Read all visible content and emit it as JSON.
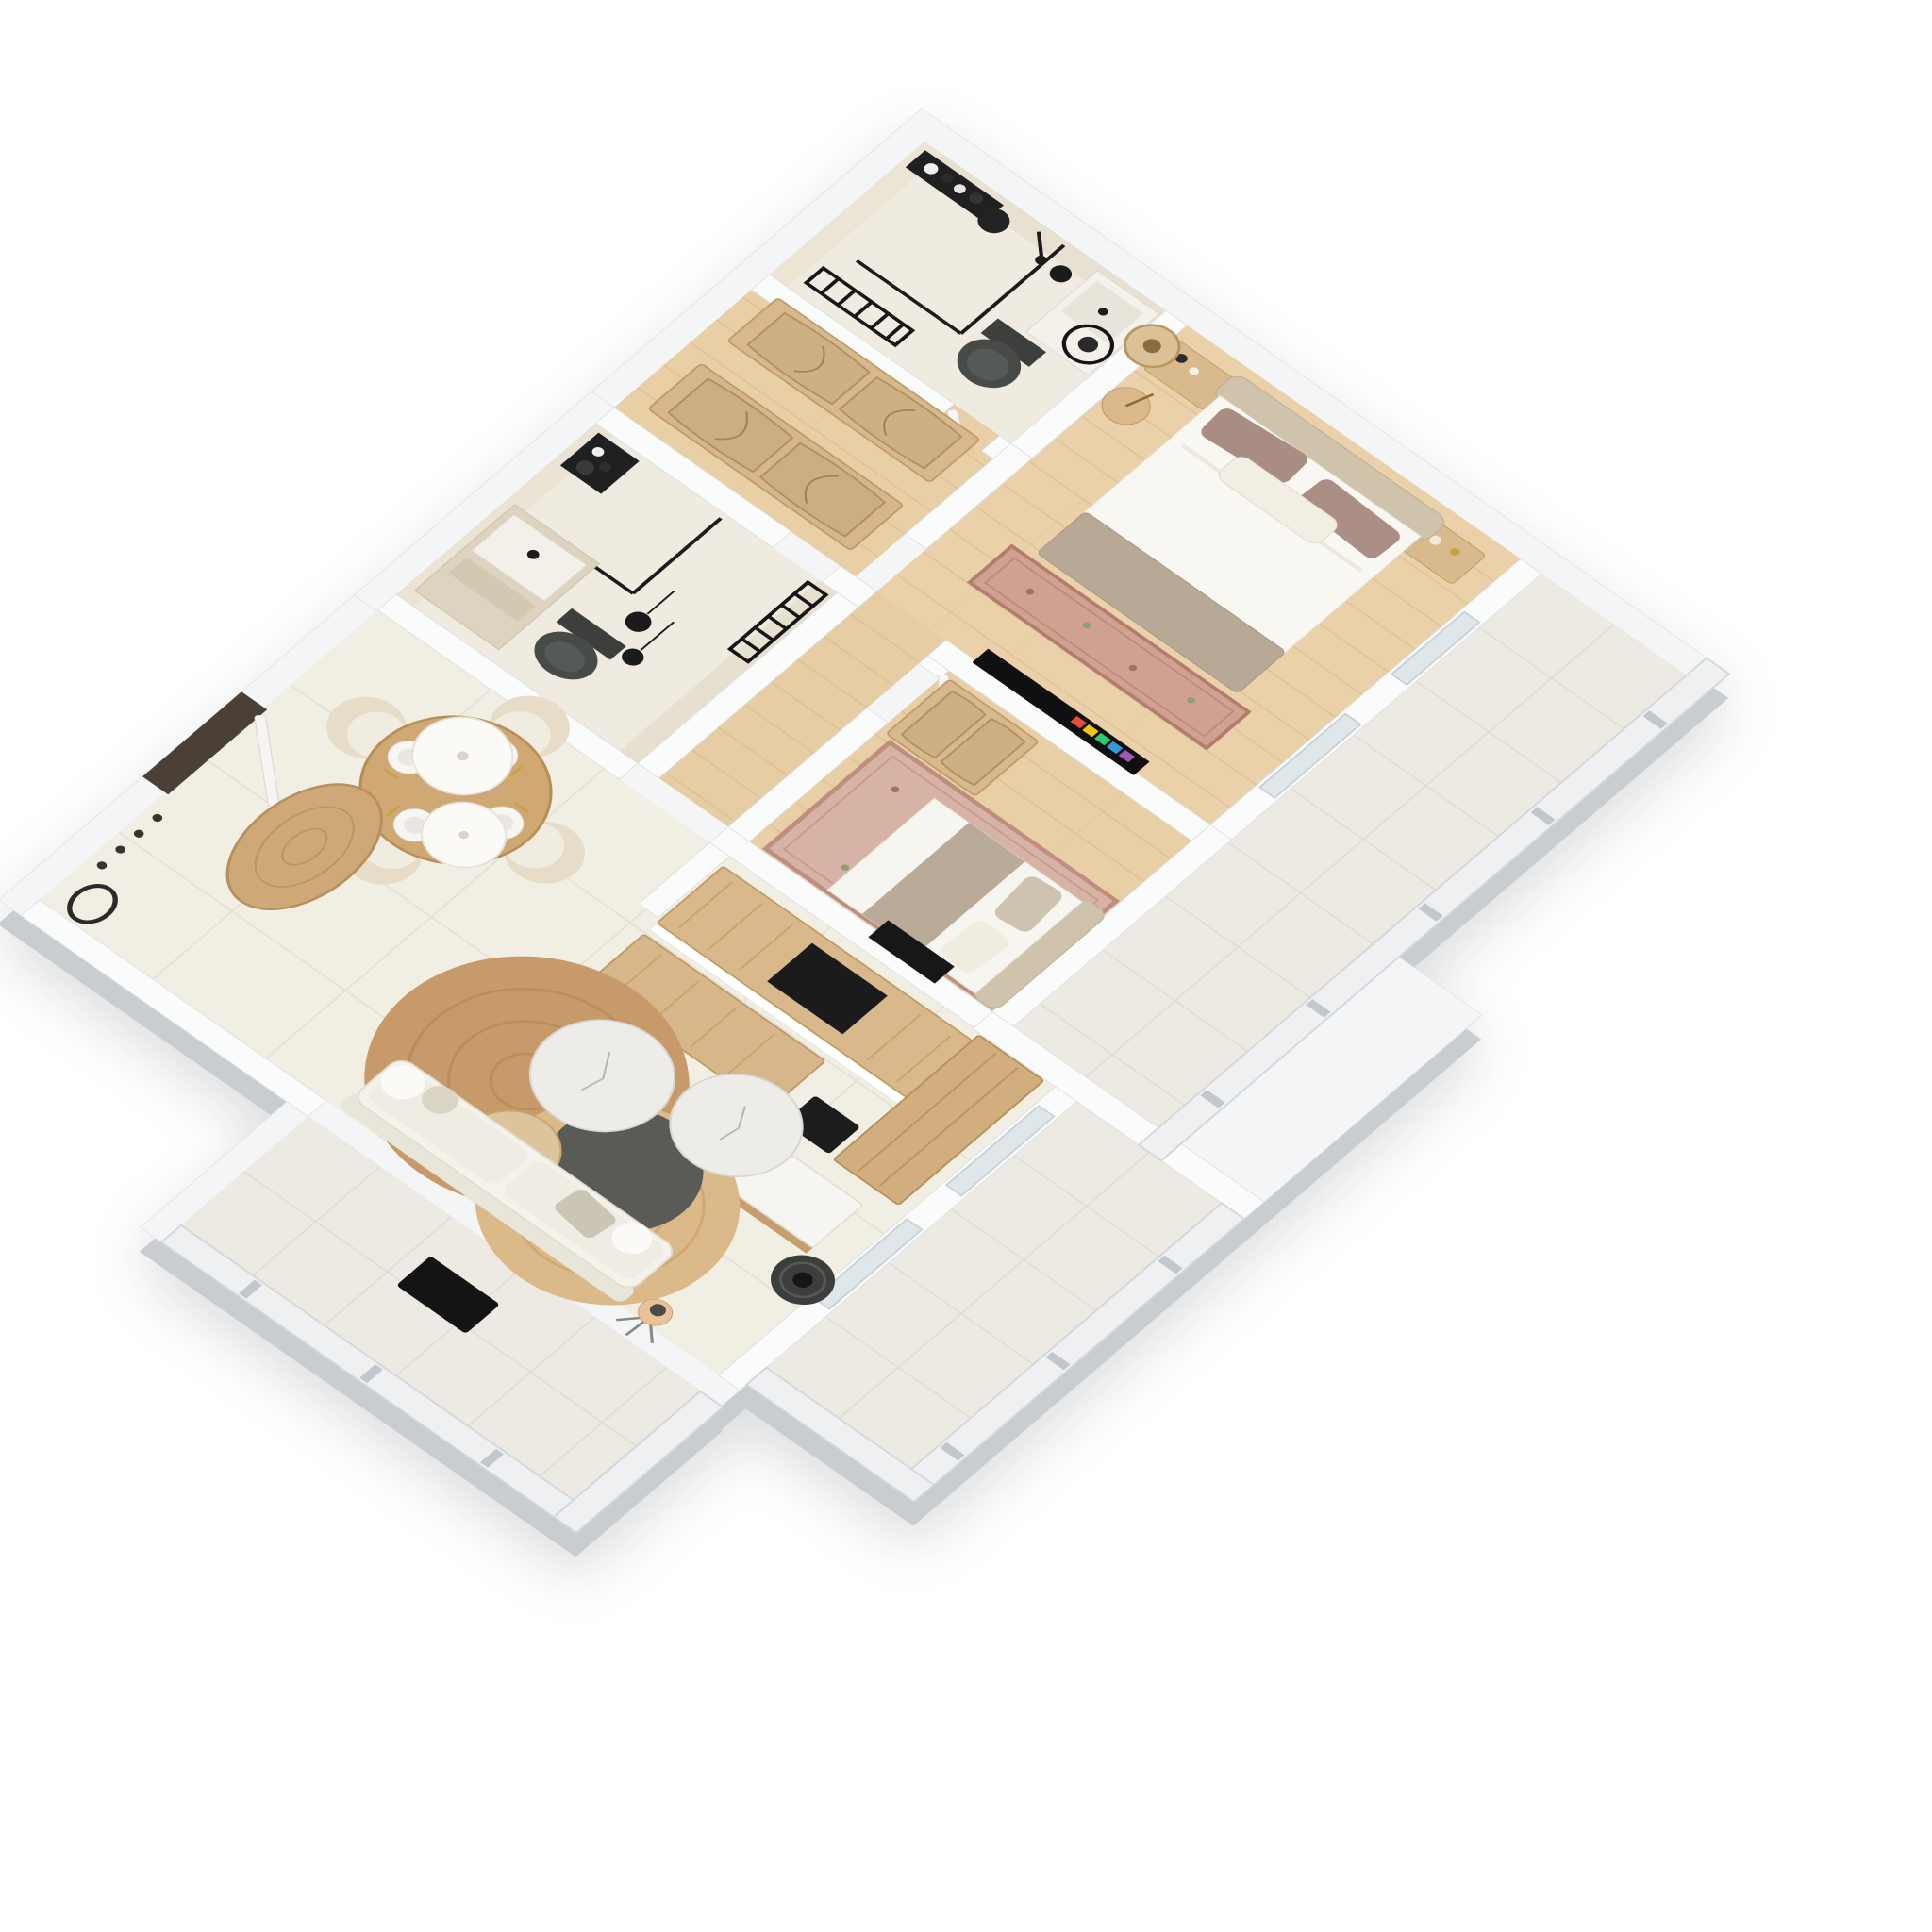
{
  "scene": {
    "kind": "3d-isometric-floorplan-render",
    "style": "scandinavian apartment, top-down dimetric camera",
    "background": "#ffffff"
  },
  "palette": {
    "wall_top": "#f4f5f6",
    "wall_side": "#c9ccd0",
    "wall_inner_beige": "#e4ddcd",
    "tile_floor": "#f1eee4",
    "bath_floor": "#efebe0",
    "wood_floor": "#e9cfa6",
    "wood_furniture": "#d9b98c",
    "rattan": "#d3b488",
    "jute_dark": "#c89a6a",
    "jute_light": "#dcb988",
    "marble": "#edece8",
    "dark_table": "#5a5a57",
    "sofa": "#f4f2ea",
    "duvet": "#f8f7f2",
    "blanket_taupe": "#b7a995",
    "pillow_mauve": "#a98c83",
    "headboard": "#cfc3ab",
    "rug_oriental": "#d0a091",
    "fixture_black": "#1c1c1c",
    "toilet_gray": "#474a47",
    "door_frame_dark": "#4a4038",
    "glass_railing": "#eef0f2",
    "tv_icon_colors": [
      "#e74c3c",
      "#f1c40f",
      "#2ecc71",
      "#3498db",
      "#9b59b6",
      "#e67e22"
    ],
    "book_colors": [
      "#c0392b",
      "#2980b9",
      "#16a085",
      "#f39c12",
      "#8e44ad",
      "#2c3e50"
    ]
  },
  "rooms": [
    {
      "id": "bathroom-ensuite",
      "label": "Ensuite bathroom",
      "furniture": [
        "walk-in shower with black glass",
        "toiletry shelf",
        "black towel radiator",
        "dark wall-hung toilet",
        "vanity sink with black faucet",
        "round black mirror",
        "black pendant lamp"
      ]
    },
    {
      "id": "hallway-wardrobes",
      "label": "Hallway with wardrobes",
      "furniture": [
        "rattan cane wardrobe",
        "rattan cane wardrobe"
      ]
    },
    {
      "id": "master-bedroom",
      "label": "Master bedroom",
      "furniture": [
        "double bed with white duvet, taupe throw and mauve pillows",
        "upholstered headboard",
        "wood bench",
        "nightstand",
        "two rattan pendant lamps",
        "plant stool",
        "oriental runner rug",
        "wall TV with app icons"
      ]
    },
    {
      "id": "balcony-east",
      "label": "East balcony",
      "furniture": [
        "glass railing",
        "tile floor"
      ]
    },
    {
      "id": "second-bedroom",
      "label": "Second bedroom",
      "furniture": [
        "double bed with beige throw",
        "rattan cane wardrobe",
        "large oriental rug",
        "dark wall niche"
      ]
    },
    {
      "id": "bathroom-second",
      "label": "Second bathroom",
      "furniture": [
        "corner shower with black glass",
        "toiletry shelf",
        "black towel radiator",
        "two black pendant lamps",
        "dark toilet",
        "beige vanity cabinet"
      ]
    },
    {
      "id": "kitchen",
      "label": "Kitchen",
      "furniture": [
        "wood island with black cooktop inset",
        "wood bar island",
        "tall wood cabinet column",
        "black floor mat"
      ]
    },
    {
      "id": "dining-area",
      "label": "Dining area",
      "furniture": [
        "round wood dining table",
        "four cream barrel chairs",
        "four place settings with gold cutlery",
        "two white disc pendant lamps"
      ]
    },
    {
      "id": "entry",
      "label": "Entry",
      "furniture": [
        "dark framed entry door",
        "oval jute rug",
        "coat rack",
        "floor mirror"
      ]
    },
    {
      "id": "living-room",
      "label": "Living room",
      "furniture": [
        "white sofa with cushions",
        "round jute rug dark",
        "round jute rug light",
        "two round marble coffee tables",
        "dark round coffee table",
        "light wood side table",
        "media console with colorful books and vases",
        "ribbed floor vase",
        "tripod floor lamp"
      ]
    },
    {
      "id": "terrace-south",
      "label": "South terrace",
      "furniture": [
        "white railing",
        "black doormat",
        "tile floor"
      ]
    },
    {
      "id": "terrace-east",
      "label": "East terrace",
      "furniture": [
        "white railing",
        "tile floor"
      ]
    }
  ]
}
